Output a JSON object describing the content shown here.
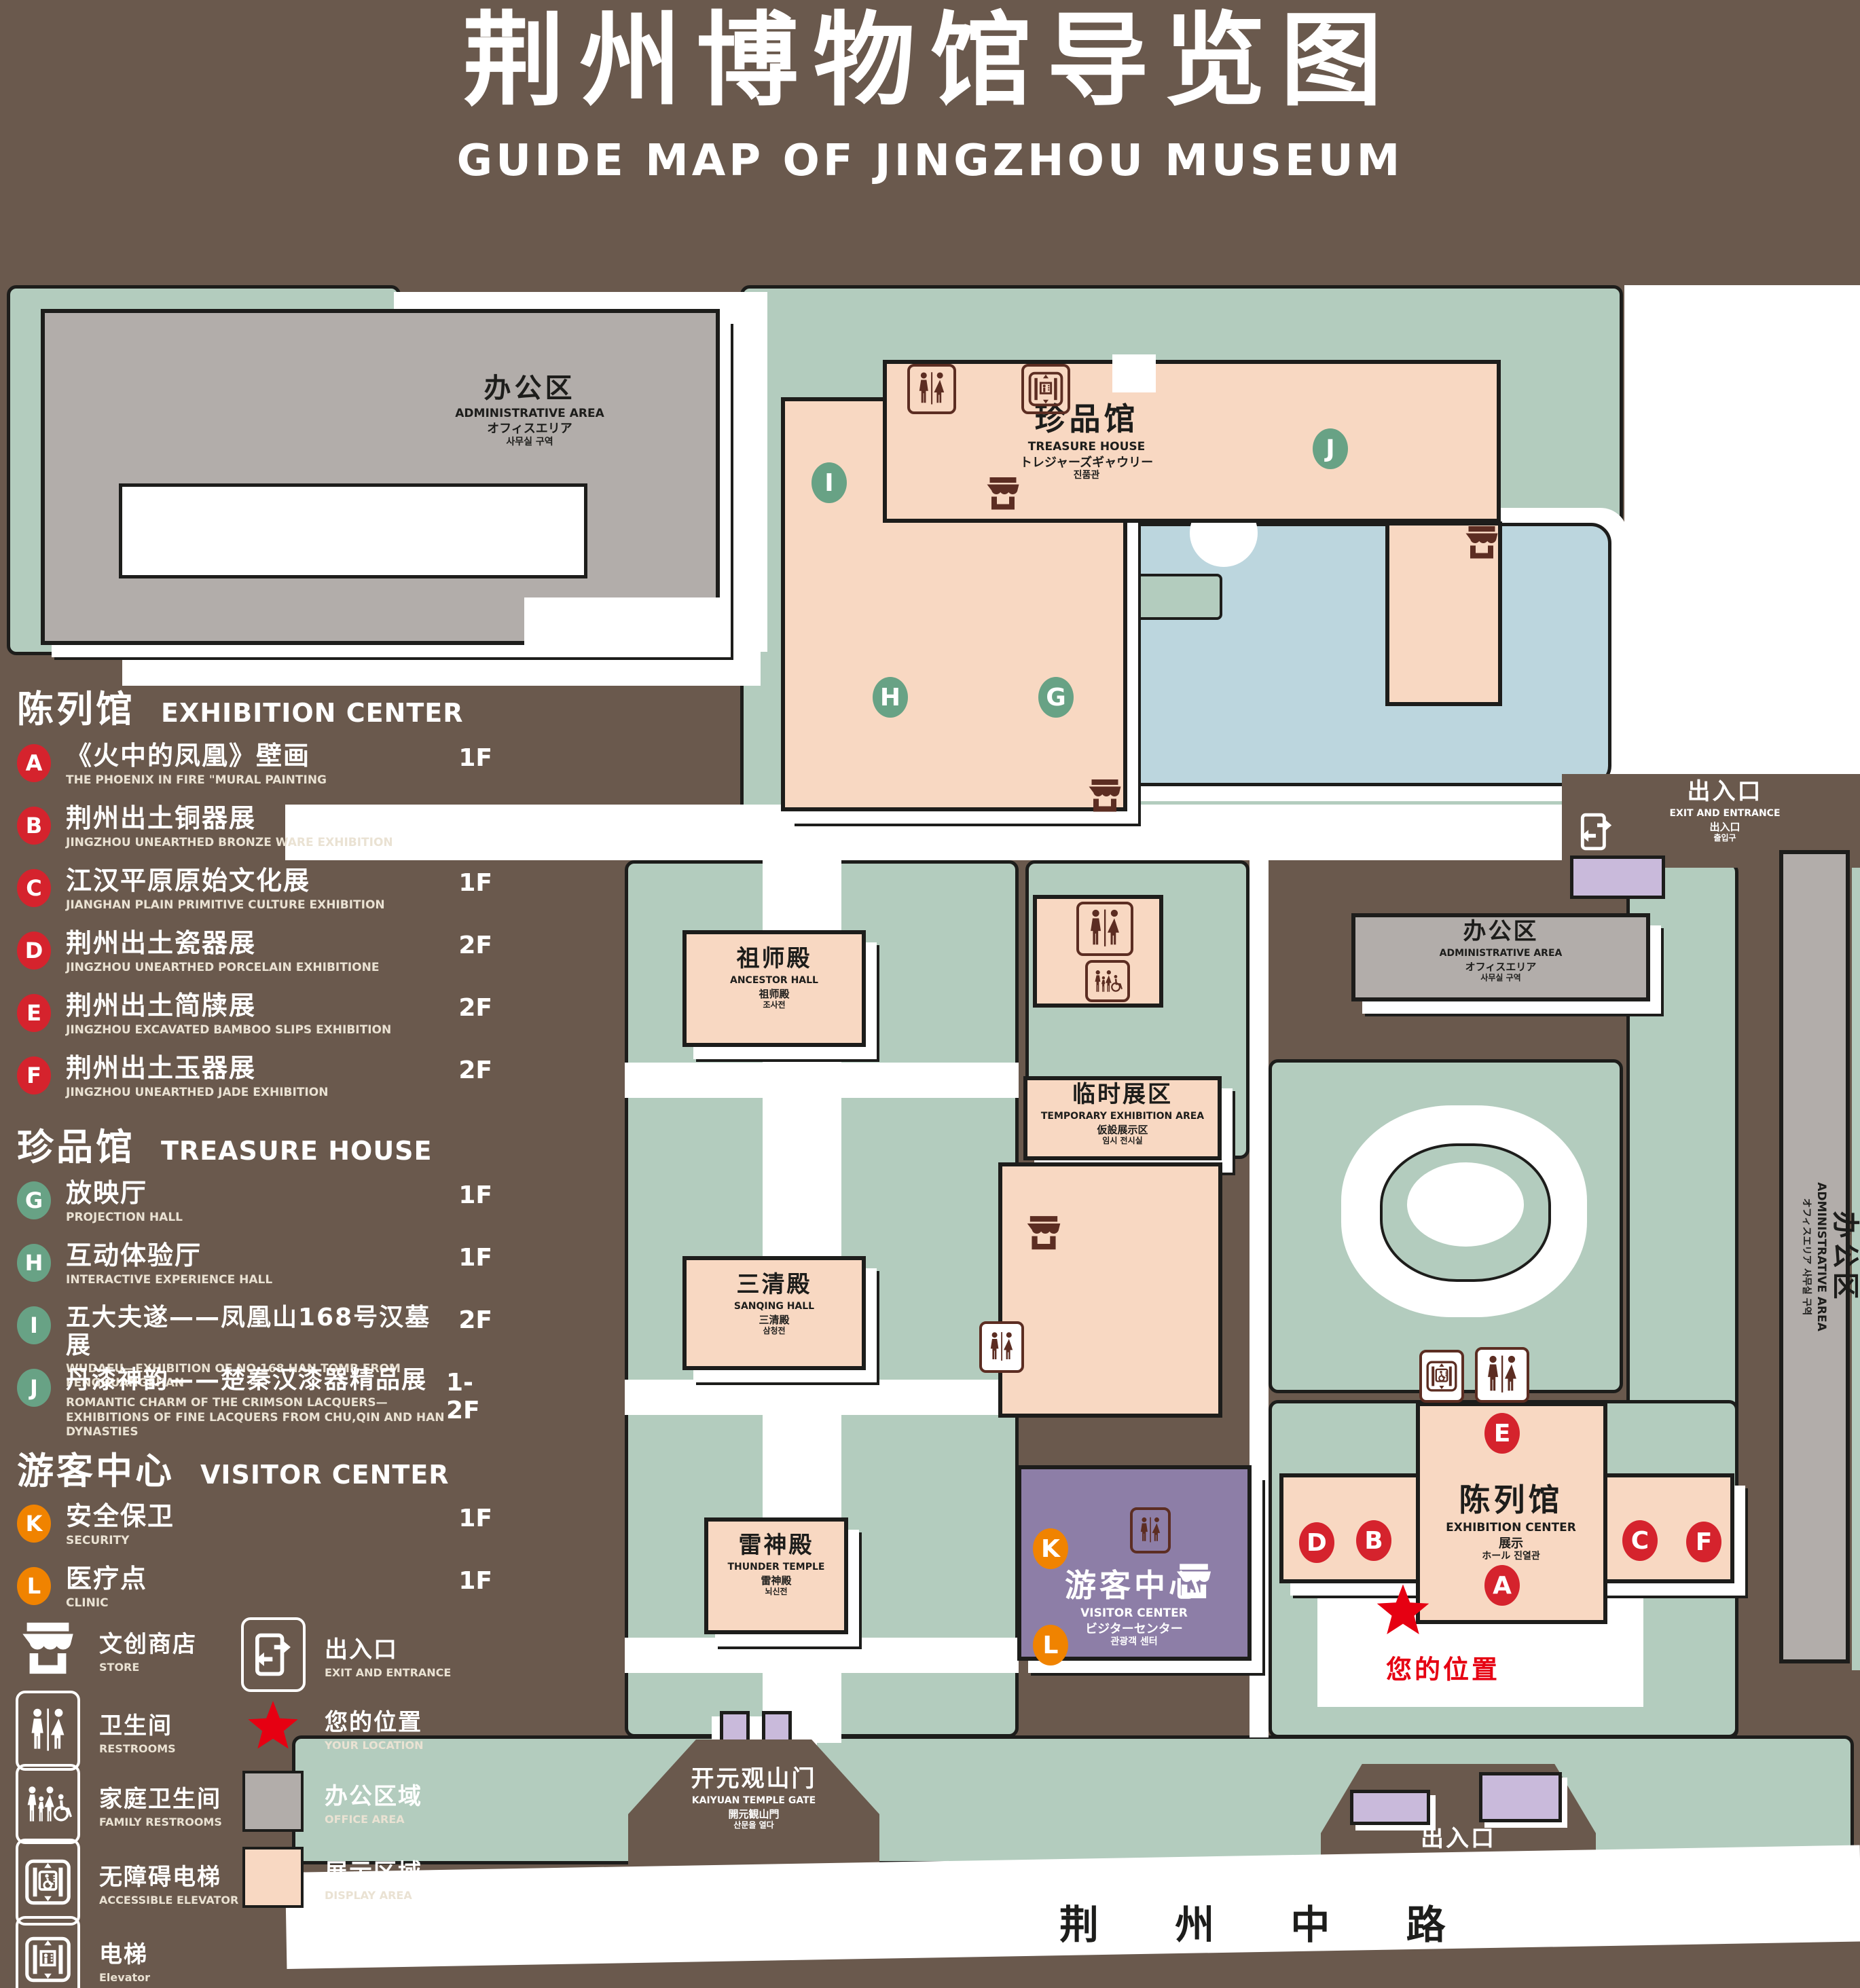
{
  "title": {
    "zh": "荆州博物馆导览图",
    "en": "GUIDE MAP OF JINGZHOU MUSEUM"
  },
  "legend": {
    "sections": [
      {
        "title_zh": "陈列馆",
        "title_en": "EXHIBITION CENTER",
        "items": [
          {
            "letter": "A",
            "zh": "《火中的凤凰》壁画",
            "en": "THE PHOENIX IN FIRE \"MURAL PAINTING",
            "floor": "1F"
          },
          {
            "letter": "B",
            "zh": "荆州出土铜器展",
            "en": "JINGZHOU UNEARTHED BRONZE WARE EXHIBITION",
            "floor": "1F"
          },
          {
            "letter": "C",
            "zh": "江汉平原原始文化展",
            "en": "JIANGHAN PLAIN PRIMITIVE CULTURE EXHIBITION",
            "floor": "1F"
          },
          {
            "letter": "D",
            "zh": "荆州出土瓷器展",
            "en": "JINGZHOU UNEARTHED PORCELAIN EXHIBITIONE",
            "floor": "2F"
          },
          {
            "letter": "E",
            "zh": "荆州出土简牍展",
            "en": "JINGZHOU EXCAVATED BAMBOO SLIPS EXHIBITION",
            "floor": "2F"
          },
          {
            "letter": "F",
            "zh": "荆州出土玉器展",
            "en": "JINGZHOU UNEARTHED JADE EXHIBITION",
            "floor": "2F"
          }
        ]
      },
      {
        "title_zh": "珍品馆",
        "title_en": "TREASURE HOUSE",
        "items": [
          {
            "letter": "G",
            "zh": "放映厅",
            "en": "PROJECTION HALL",
            "floor": "1F"
          },
          {
            "letter": "H",
            "zh": "互动体验厅",
            "en": "INTERACTIVE EXPERIENCE HALL",
            "floor": "1F"
          },
          {
            "letter": "I",
            "zh": "五大夫遂——凤凰山168号汉墓展",
            "en": "WUDAFU—EXHIBITION OF NO.168 HAN TOMB FROM FENGHUANGSHAN",
            "floor": "2F"
          },
          {
            "letter": "J",
            "zh": "丹漆神韵——楚秦汉漆器精品展",
            "en": "ROMANTIC CHARM OF THE CRIMSON LACQUERS—EXHIBITIONS OF FINE LACQUERS FROM CHU,QIN AND HAN DYNASTIES",
            "floor": "1-2F"
          }
        ]
      },
      {
        "title_zh": "游客中心",
        "title_en": "VISITOR CENTER",
        "items": [
          {
            "letter": "K",
            "zh": "安全保卫",
            "en": "SECURITY",
            "floor": "1F"
          },
          {
            "letter": "L",
            "zh": "医疗点",
            "en": "CLINIC",
            "floor": "1F"
          }
        ]
      }
    ],
    "symbols": [
      {
        "icon": "store-icon",
        "zh": "文创商店",
        "en": "STORE"
      },
      {
        "icon": "exit-icon",
        "zh": "出入口",
        "en": "EXIT AND ENTRANCE"
      },
      {
        "icon": "restrooms-icon",
        "zh": "卫生间",
        "en": "RESTROOMS"
      },
      {
        "icon": "location-star-icon",
        "zh": "您的位置",
        "en": "YOUR LOCATION"
      },
      {
        "icon": "family-restrooms-icon",
        "zh": "家庭卫生间",
        "en": "FAMILY RESTROOMS"
      },
      {
        "icon": "office-area-swatch",
        "zh": "办公区域",
        "en": "OFFICE AREA"
      },
      {
        "icon": "accessible-elevator-icon",
        "zh": "无障碍电梯",
        "en": "ACCESSIBLE ELEVATOR"
      },
      {
        "icon": "display-area-swatch",
        "zh": "展示区域",
        "en": "DISPLAY AREA"
      },
      {
        "icon": "elevator-icon",
        "zh": "电梯",
        "en": "Elevator"
      }
    ]
  },
  "map": {
    "buildings": {
      "admin": {
        "zh": "办公区",
        "en": "ADMINISTRATIVE AREA",
        "ja": "オフィスエリア",
        "ko": "사무실 구역"
      },
      "treasure_house": {
        "zh": "珍品馆",
        "en": "TREASURE HOUSE",
        "ja": "トレジャーズギャウリー",
        "ko": "진품관"
      },
      "ancestor_hall": {
        "zh": "祖师殿",
        "en": "ANCESTOR HALL",
        "ja": "祖师殿",
        "ko": "조사전"
      },
      "temporary_area": {
        "zh": "临时展区",
        "en": "TEMPORARY EXHIBITION AREA",
        "ja": "仮設展示区",
        "ko": "임시 전시실"
      },
      "sanqing_hall": {
        "zh": "三清殿",
        "en": "SANQING HALL",
        "ja": "三清殿",
        "ko": "삼청전"
      },
      "thunder_temple": {
        "zh": "雷神殿",
        "en": "THUNDER TEMPLE",
        "ja": "雷神殿",
        "ko": "뇌신전"
      },
      "visitor_center": {
        "zh": "游客中心",
        "en": "VISITOR CENTER",
        "ja": "ビジターセンター",
        "ko": "관광객 센터"
      },
      "exhibition_center": {
        "zh": "陈列馆",
        "en": "EXHIBITION CENTER",
        "ja": "展示",
        "ko": "ホール 진열관"
      },
      "gate": {
        "zh": "开元观山门",
        "en": "KAIYUAN TEMPLE GATE",
        "ja": "開元観山門",
        "ko": "산문을 열다"
      },
      "exit": {
        "zh": "出入口",
        "en": "EXIT AND ENTRANCE",
        "ja": "出入口",
        "ko": "출입구"
      }
    },
    "road": {
      "name": "荆 州 中 路"
    },
    "your_location": "您的位置",
    "markers": [
      "A",
      "B",
      "C",
      "D",
      "E",
      "F",
      "G",
      "H",
      "I",
      "J",
      "K",
      "L"
    ]
  },
  "colors": {
    "background": "#6a594d",
    "green_area": "#b3ccbe",
    "display_area": "#f8d8c2",
    "office_area": "#b2adaa",
    "visitor_center": "#8d7ea7",
    "gate_building": "#c9badb",
    "pond": "#bcd6de",
    "marker_red": "#d5232d",
    "marker_green": "#68a285",
    "marker_orange": "#f08300",
    "location_red": "#e60012",
    "outline": "#1d1d1b"
  }
}
